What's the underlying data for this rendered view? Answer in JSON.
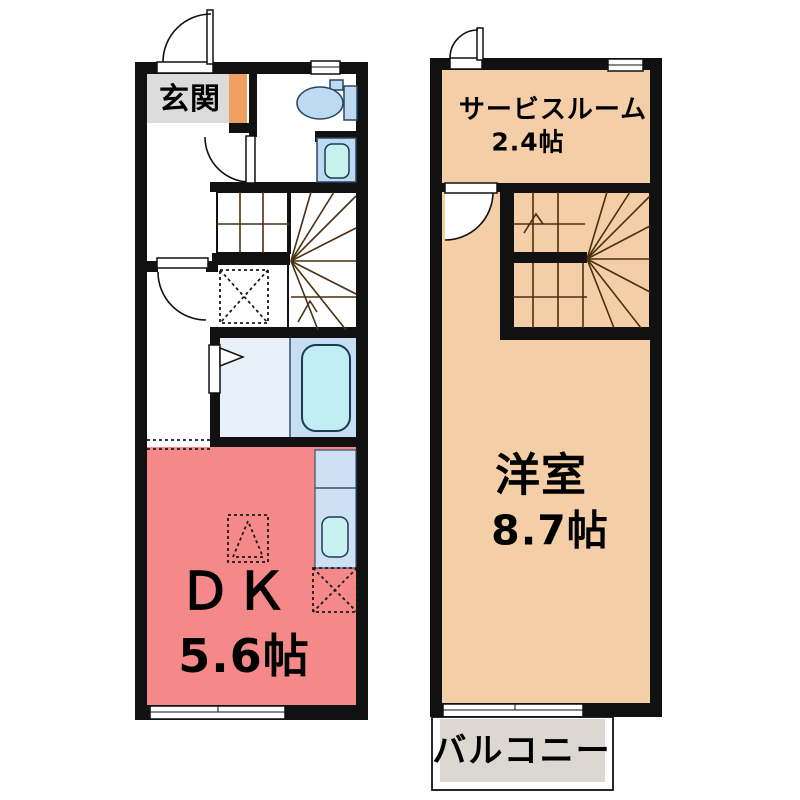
{
  "floor1": {
    "entrance_label": "玄関",
    "room_label": "ＤＫ",
    "room_size": "5.6帖"
  },
  "floor2": {
    "service_room_label": "サービスルーム",
    "service_room_size": "2.4帖",
    "room_label": "洋室",
    "room_size": "8.7帖",
    "balcony_label": "バルコニー"
  },
  "colors": {
    "wall": "#111111",
    "stairs": "#efa95a",
    "stair_line": "#4a2f10",
    "dk_pink": "#f58888",
    "room_tan": "#f3cea7",
    "genkan_gray": "#dbdbdb",
    "genkan_step_orange": "#efa060",
    "balcony_gray": "#dcd8d1",
    "fixture_blue": "#bedaf2",
    "bath_blue": "#c5def4",
    "washroom_blue": "#e8f1fa",
    "tub_cyan": "#c0eef2",
    "sink_cyan": "#c6f1ef",
    "counter_blue": "#cde0f4"
  }
}
